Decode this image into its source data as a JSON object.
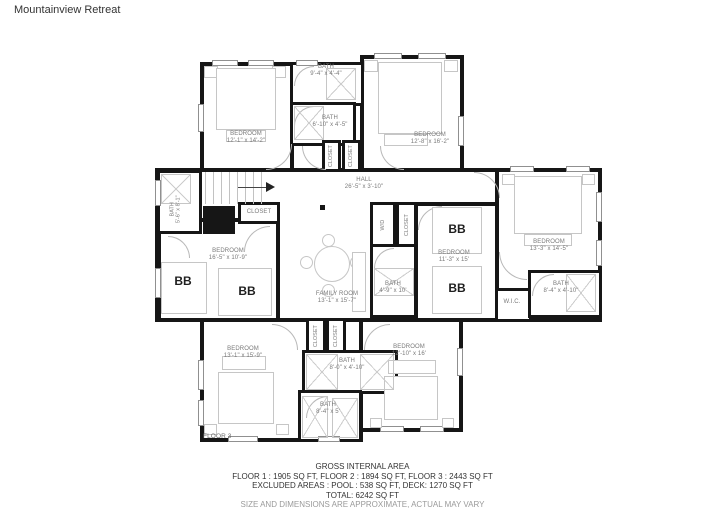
{
  "title": "Mountainview Retreat",
  "floorLabel": "FLOOR 3",
  "bunkLabel": "BB",
  "rooms": {
    "closetLabel": "CLOSET",
    "wdLabel": "W/D",
    "wicLabel": "W.I.C.",
    "bedroomTopLeft": {
      "name": "BEDROOM",
      "dims": "12'-1\" x 14'-2\""
    },
    "bathTop1": {
      "name": "BATH",
      "dims": "9'-4\" x 4'-4\""
    },
    "bathTop2": {
      "name": "BATH",
      "dims": "6'-10\" x 4'-5\""
    },
    "bedroomTopRight": {
      "name": "BEDROOM",
      "dims": "12'-8\" x 16'-2\""
    },
    "hall": {
      "name": "HALL",
      "dims": "26'-5\" x 3'-10\""
    },
    "bathMidLeft": {
      "name": "BATH",
      "dims": "5'-6\" x 8'-1\""
    },
    "bedroomMidLeft": {
      "name": "BEDROOM",
      "dims": "16'-5\" x 10'-9\""
    },
    "familyRoom": {
      "name": "FAMILY ROOM",
      "dims": "13'-1\" x 15'-7\""
    },
    "bathCenter": {
      "name": "BATH",
      "dims": "4'-9\" x 10'"
    },
    "bedroomMidRight": {
      "name": "BEDROOM",
      "dims": "11'-3\" x 15'"
    },
    "bedroomRight": {
      "name": "BEDROOM",
      "dims": "13'-3\" x 14'-5\""
    },
    "bathRight": {
      "name": "BATH",
      "dims": "8'-4\" x 4'-10\""
    },
    "bedroomBottomLeft": {
      "name": "BEDROOM",
      "dims": "13'-1\" x 15'-9\""
    },
    "bathBottom1": {
      "name": "BATH",
      "dims": "8'-0\" x 4'-10\""
    },
    "bathBottom2": {
      "name": "BATH",
      "dims": "8'-4\" x 5'"
    },
    "bedroomBottomRight": {
      "name": "BEDROOM",
      "dims": "12'-10\" x 16'"
    }
  },
  "footer": {
    "line1": "GROSS INTERNAL AREA",
    "line2": "FLOOR 1 : 1905 SQ FT, FLOOR 2 : 1894 SQ FT, FLOOR 3 : 2443 SQ FT",
    "line3": "EXCLUDED AREAS : POOL : 538 SQ FT, DECK: 1270 SQ FT",
    "line4": "TOTAL: 6242 SQ FT",
    "line5": "SIZE AND DIMENSIONS ARE APPROXIMATE, ACTUAL MAY VARY"
  },
  "colors": {
    "wall": "#161616",
    "labelText": "#7a7a7a",
    "furniture": "#c6c6c6"
  }
}
